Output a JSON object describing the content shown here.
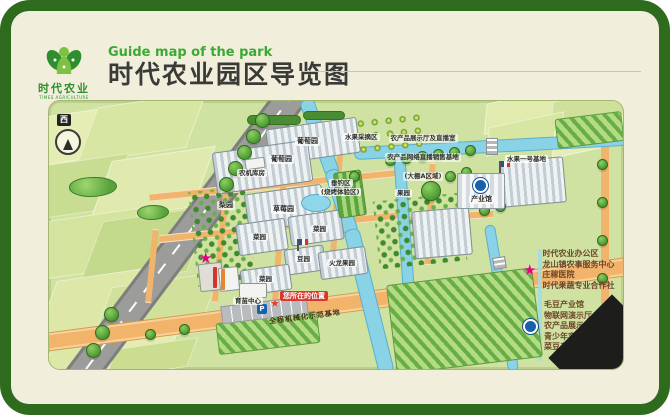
{
  "header": {
    "subtitle_en": "Guide map of the park",
    "title_cn": "时代农业园区导览图",
    "logo_cn": "时代农业",
    "logo_en": "TIMES AGRICULTURE"
  },
  "map": {
    "compass": "西",
    "labels": {
      "grape_a": "葡萄园",
      "grape_b": "葡萄园",
      "machine_shed": "农机库房",
      "fruit_picking": "水果采摘区",
      "fishing": "垂钓区",
      "fishing_sub": "(烧烤体验区)",
      "pear": "梨园",
      "strawberry": "草莓园",
      "veg_a": "菜园",
      "veg_b": "菜园",
      "veg_c": "菜园",
      "bean": "豆园",
      "dragonfruit": "火龙果园",
      "orchard": "果园",
      "nursery": "育苗中心",
      "industry_hall": "产业馆",
      "fruit_base": "水果一号基地",
      "display_line1": "农产品展示厅及直播室",
      "display_line2": "农产品网络直播销售基地",
      "display_line3": "(大棚A区域)",
      "road": "全程机械化示范基地",
      "you_are_here": "您所在的位置",
      "parking": "P"
    }
  },
  "legend": {
    "star_items": [
      "时代农业办公区",
      "龙山镇农事服务中心",
      "庄稼医院",
      "时代果蔬专业合作社"
    ],
    "circle_items": [
      "毛豆产业馆",
      "物联网演示厅",
      "农产品展示厅、直播室",
      "青少年实践基地",
      "菜豆产业农合联"
    ]
  },
  "colors": {
    "frame_green": "#2f6b1c",
    "card_cream": "#f1eedb",
    "map_green": "#cfe2a2",
    "accent_green": "#3aaa35",
    "title_dark": "#3a3a38",
    "star_pink": "#e5007d",
    "marker_blue": "#1961ac",
    "legend_text": "#6e4528",
    "river_blue": "#8ad2e6",
    "road_orange": "#f2b46a",
    "here_red": "#d8382e"
  }
}
